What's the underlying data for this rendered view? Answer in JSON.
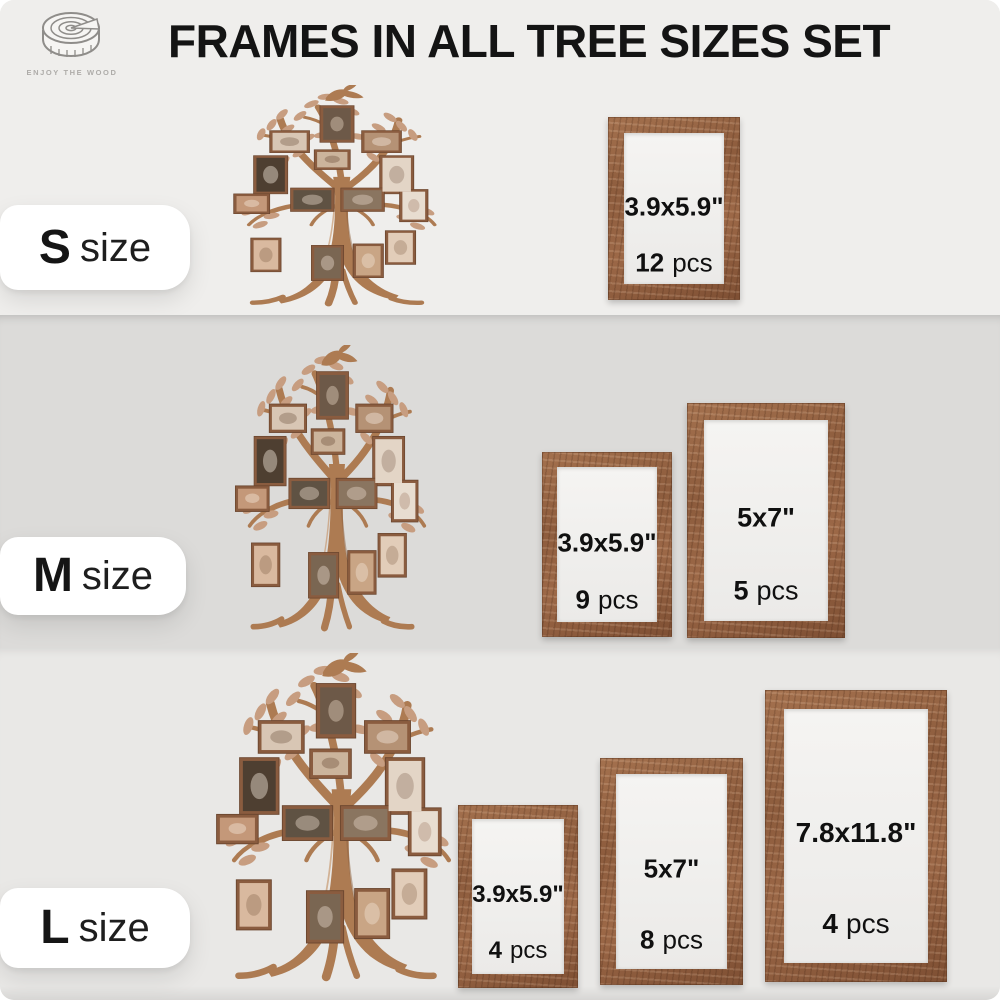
{
  "page": {
    "title": "FRAMES IN ALL TREE SIZES SET"
  },
  "logo": {
    "brand": "ENJOY THE WOOD",
    "icon": "wood-slice-icon"
  },
  "colors": {
    "band_s_bg": "#efeeec",
    "band_m_bg": "#dcdbd9",
    "band_l_bg": "#e9e8e6",
    "label_pill_bg": "#ffffff",
    "frame_wood": "#96684a",
    "frame_mat": "#f4f3f1",
    "tree_wood": "#ad7b52",
    "leaf": "#c79d80",
    "text": "#141414",
    "brand_text": "#aeaca9"
  },
  "rows": [
    {
      "id": "S",
      "label_bold": "S",
      "label_rest": "size",
      "frames": [
        {
          "size": "3.9x5.9\"",
          "count": "12",
          "unit": "pcs"
        }
      ]
    },
    {
      "id": "M",
      "label_bold": "M",
      "label_rest": "size",
      "frames": [
        {
          "size": "3.9x5.9\"",
          "count": "9",
          "unit": "pcs"
        },
        {
          "size": "5x7\"",
          "count": "5",
          "unit": "pcs"
        }
      ]
    },
    {
      "id": "L",
      "label_bold": "L",
      "label_rest": "size",
      "frames": [
        {
          "size": "3.9x5.9\"",
          "count": "4",
          "unit": "pcs"
        },
        {
          "size": "5x7\"",
          "count": "8",
          "unit": "pcs"
        },
        {
          "size": "7.8x11.8\"",
          "count": "4",
          "unit": "pcs"
        }
      ]
    }
  ]
}
